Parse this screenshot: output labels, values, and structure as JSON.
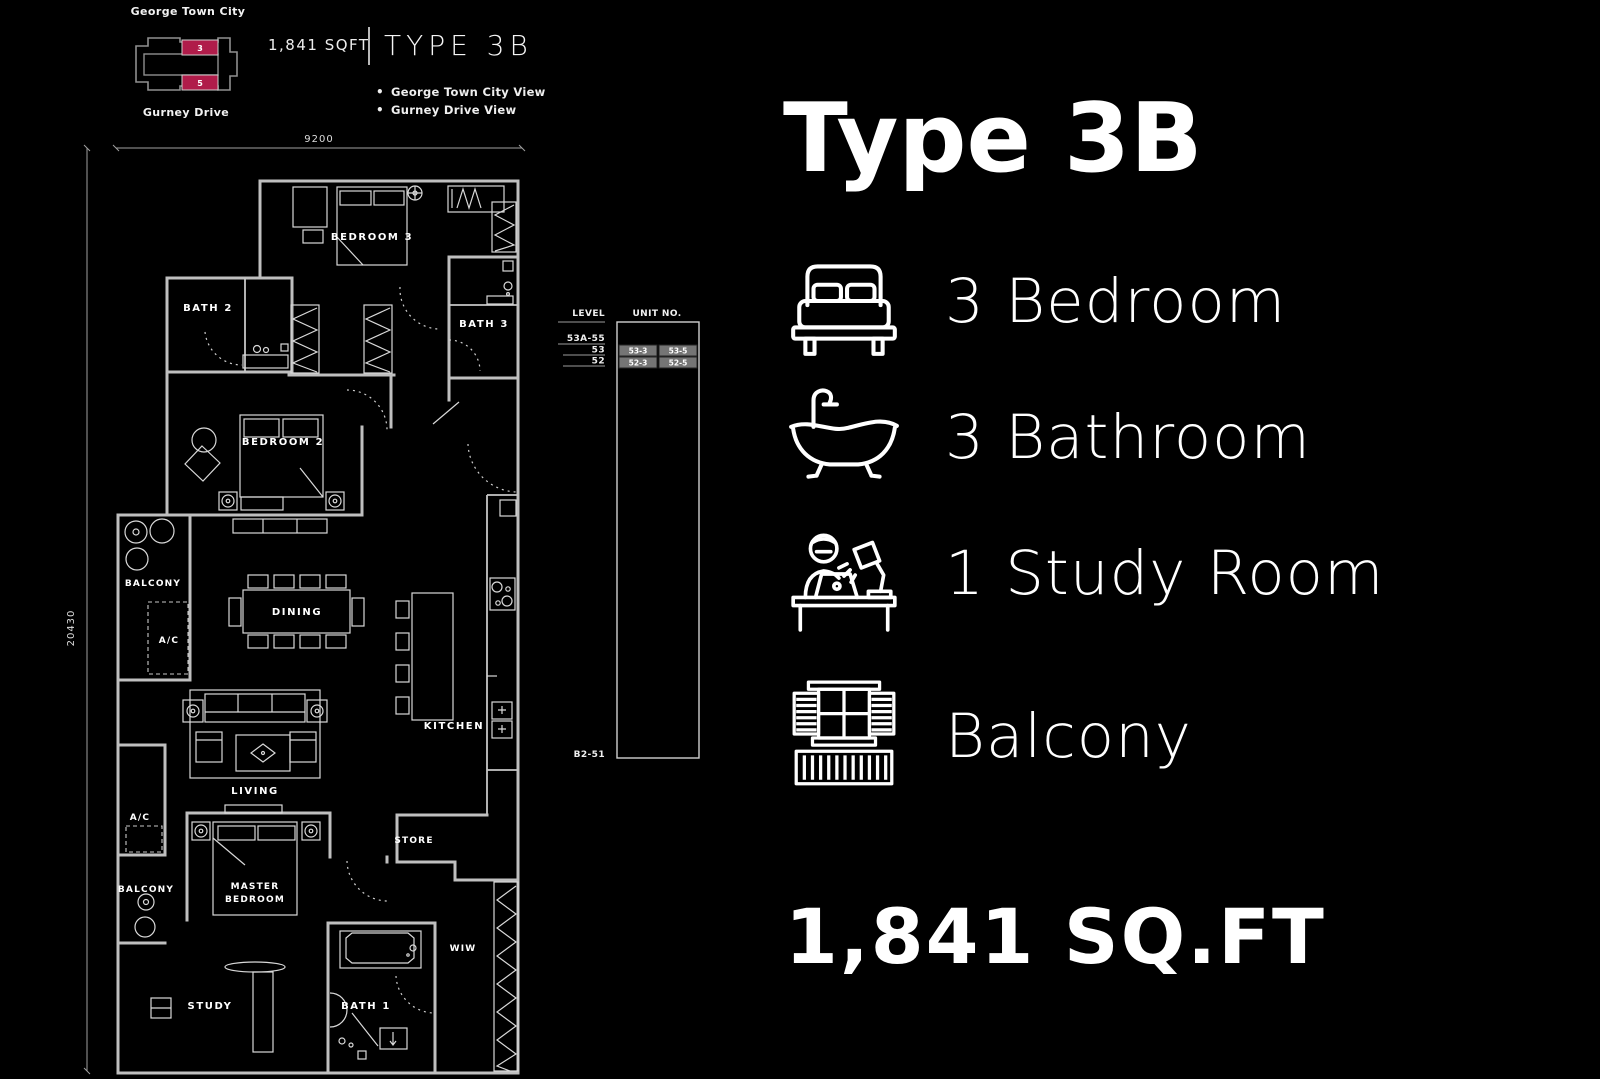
{
  "site_plan": {
    "top_label": "George Town City",
    "bottom_label": "Gurney Drive",
    "unit_top_label": "3",
    "unit_bottom_label": "5",
    "highlight_color": "#b01c4a"
  },
  "header": {
    "area": "1,841 SQFT",
    "type_label": "TYPE 3B",
    "views": [
      "George Town City View",
      "Gurney Drive View"
    ]
  },
  "floorplan": {
    "dim_top": "9200",
    "dim_left": "20430",
    "rooms": {
      "bedroom3": "BEDROOM 3",
      "bath2": "BATH 2",
      "bath3": "BATH 3",
      "bedroom2": "BEDROOM 2",
      "balcony_upper": "BALCONY",
      "ac_upper": "A/C",
      "dining": "DINING",
      "kitchen": "KITCHEN",
      "living": "LIVING",
      "ac_lower": "A/C",
      "balcony_lower": "BALCONY",
      "master_line1": "MASTER",
      "master_line2": "BEDROOM",
      "store": "STORE",
      "wiw": "WIW",
      "study": "STUDY",
      "bath1": "BATH 1"
    }
  },
  "stack_table": {
    "level_header": "LEVEL",
    "unit_header": "UNIT NO.",
    "rows": [
      {
        "level": "53A-55",
        "units": []
      },
      {
        "level": "53",
        "units": [
          "53-3",
          "53-5"
        ]
      },
      {
        "level": "52",
        "units": [
          "52-3",
          "52-5"
        ]
      }
    ],
    "basement_label": "B2-51"
  },
  "panel": {
    "title": "Type 3B",
    "features": [
      {
        "icon": "bed-icon",
        "label": "3 Bedroom"
      },
      {
        "icon": "bathtub-icon",
        "label": "3 Bathroom"
      },
      {
        "icon": "study-desk-icon",
        "label": "1 Study Room"
      },
      {
        "icon": "balcony-icon",
        "label": "Balcony"
      }
    ],
    "area": "1,841 SQ.FT"
  }
}
